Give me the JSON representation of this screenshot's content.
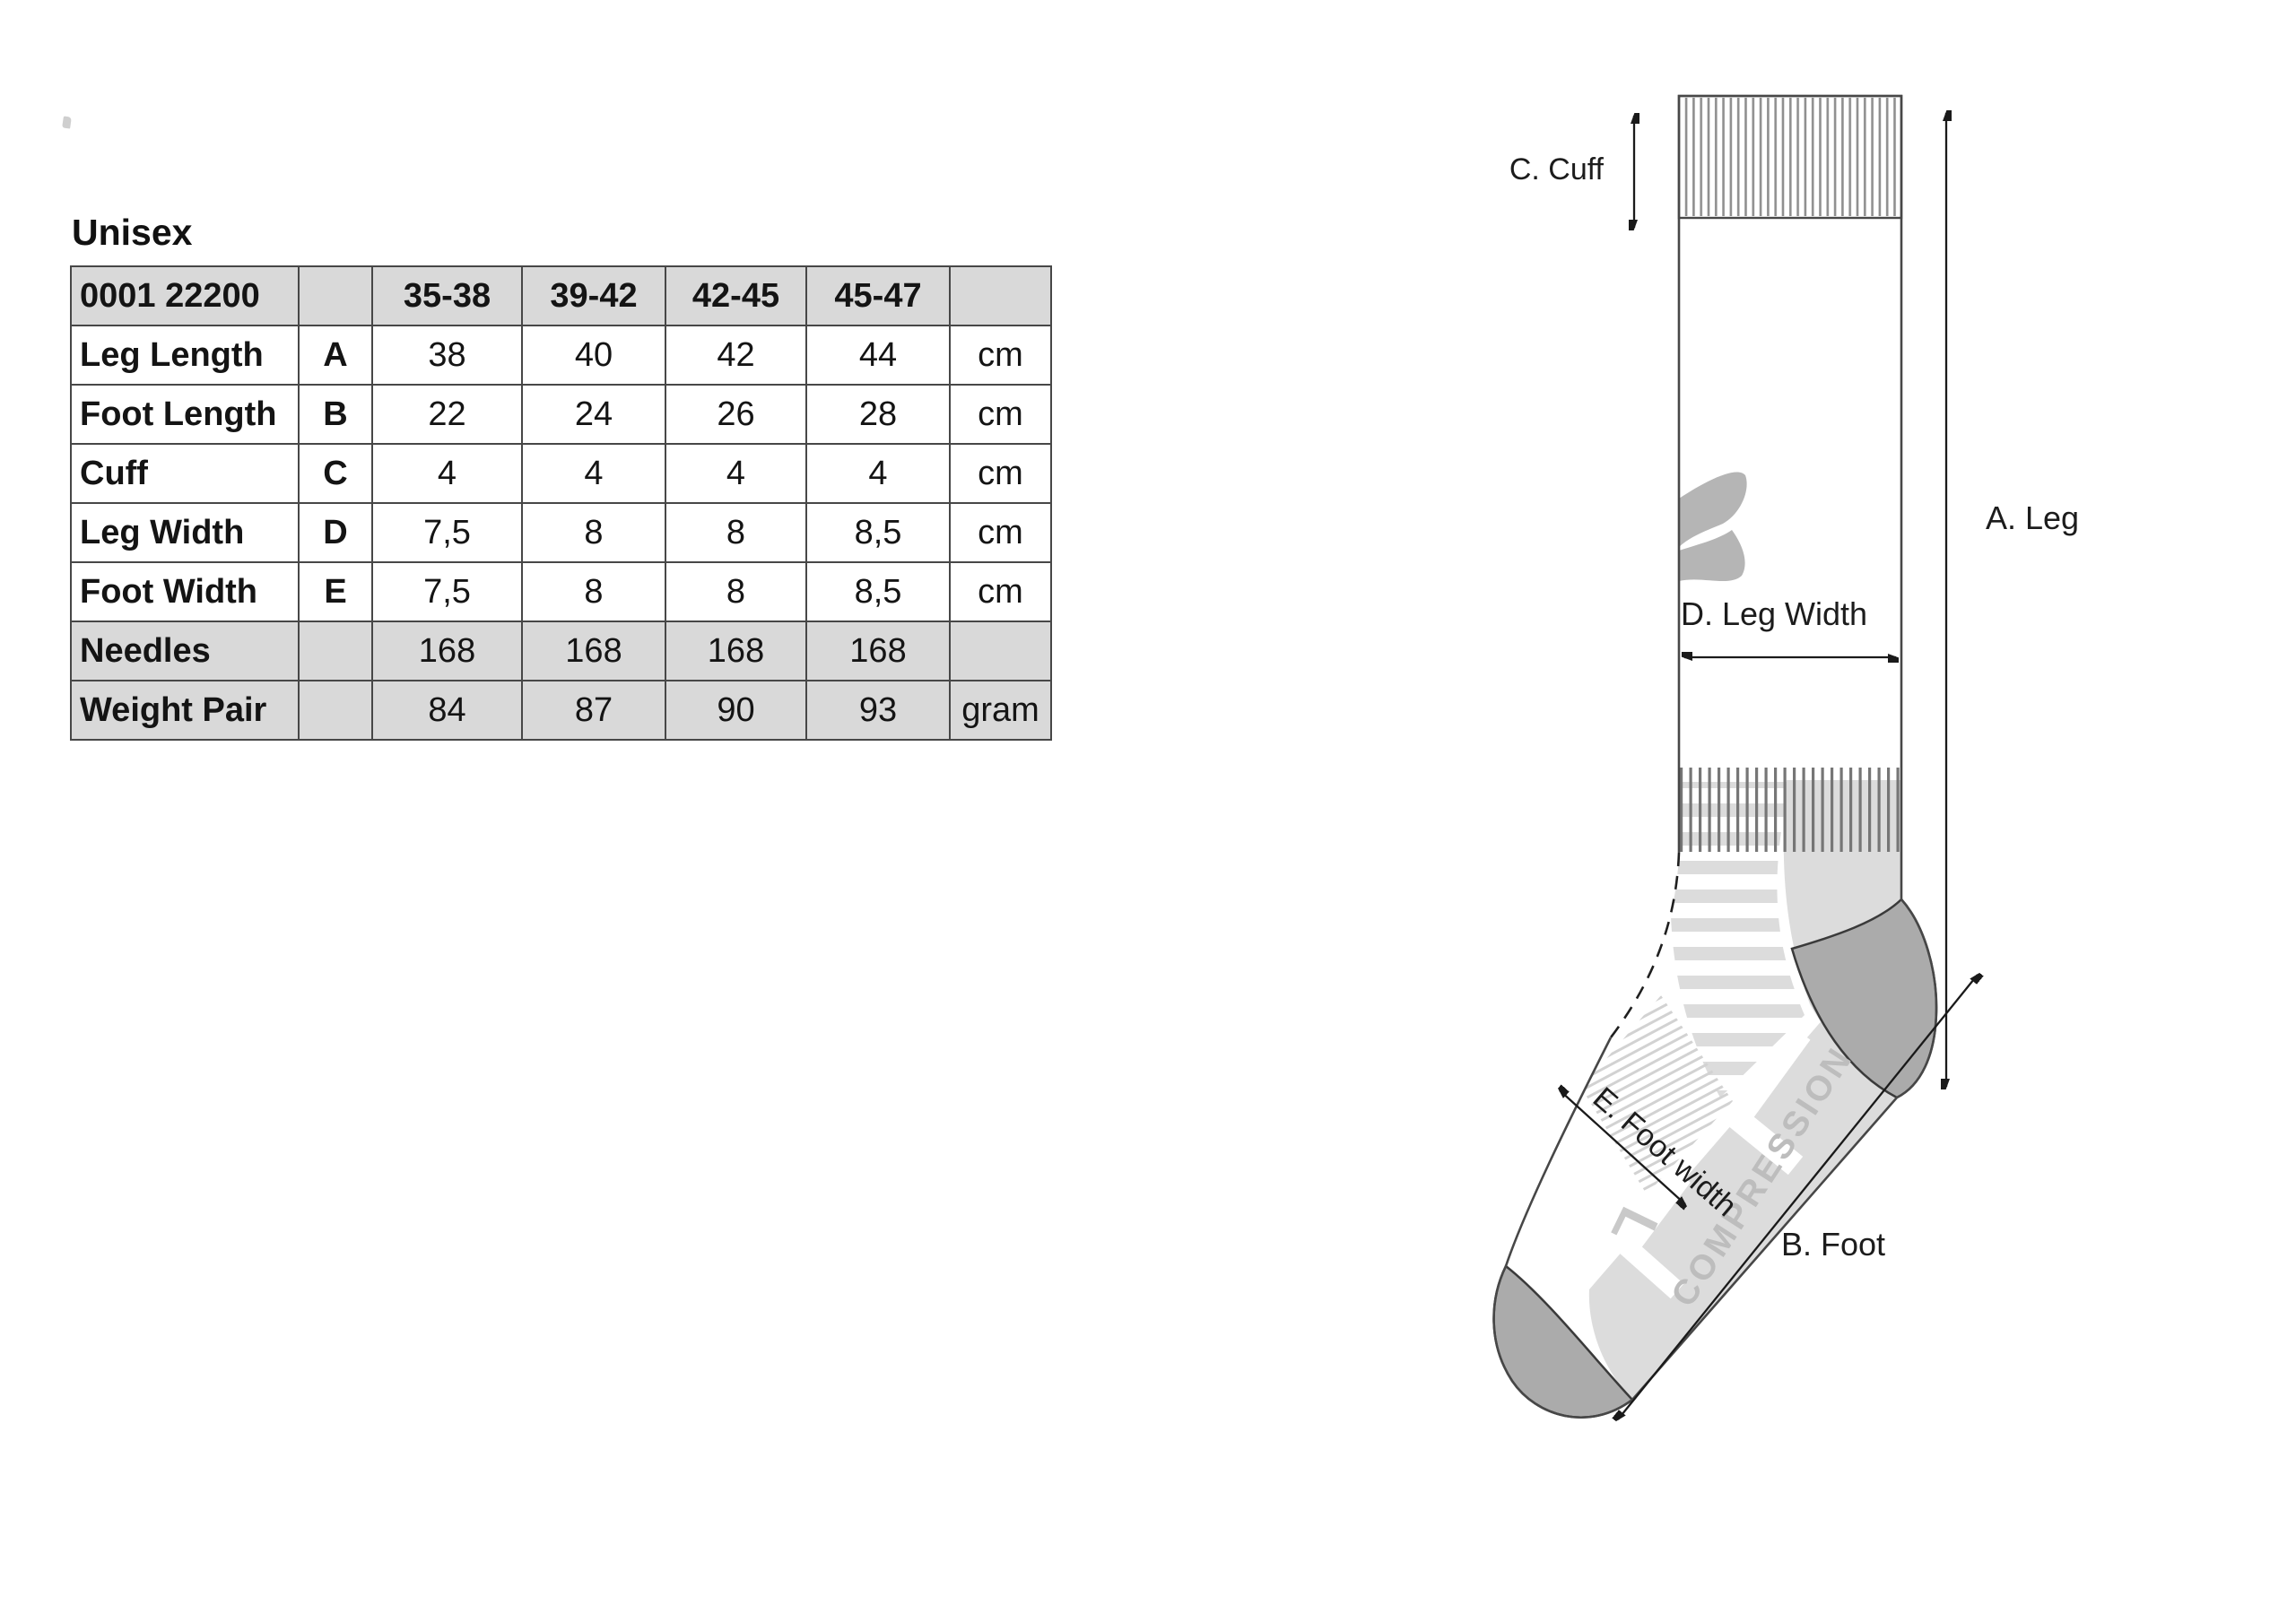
{
  "page": {
    "title": "Unisex"
  },
  "size_table": {
    "product_code": "0001 22200",
    "size_columns": [
      "35-38",
      "39-42",
      "42-45",
      "45-47"
    ],
    "rows": [
      {
        "label": "Leg Length",
        "letter": "A",
        "values": [
          "38",
          "40",
          "42",
          "44"
        ],
        "unit": "cm"
      },
      {
        "label": "Foot Length",
        "letter": "B",
        "values": [
          "22",
          "24",
          "26",
          "28"
        ],
        "unit": "cm"
      },
      {
        "label": "Cuff",
        "letter": "C",
        "values": [
          "4",
          "4",
          "4",
          "4"
        ],
        "unit": "cm"
      },
      {
        "label": "Leg Width",
        "letter": "D",
        "values": [
          "7,5",
          "8",
          "8",
          "8,5"
        ],
        "unit": "cm"
      },
      {
        "label": "Foot Width",
        "letter": "E",
        "values": [
          "7,5",
          "8",
          "8",
          "8,5"
        ],
        "unit": "cm"
      },
      {
        "label": "Needles",
        "letter": "",
        "values": [
          "168",
          "168",
          "168",
          "168"
        ],
        "unit": ""
      },
      {
        "label": "Weight Pair",
        "letter": "",
        "values": [
          "84",
          "87",
          "90",
          "93"
        ],
        "unit": "gram"
      }
    ]
  },
  "diagram": {
    "labels": {
      "leg": "A. Leg",
      "foot": "B. Foot",
      "cuff": "C. Cuff",
      "leg_width": "D. Leg Width",
      "foot_width": "E. Foot width"
    },
    "sock_text": "COMPRESSION",
    "size_mark": "L",
    "colors": {
      "pattern_gray": "#dcdcdc",
      "patch_gray": "#ababab",
      "rib_gray": "#8f8f8f",
      "outline": "#474747",
      "shaded_row": "#d9d9d9",
      "knit_text": "#bdbdbd"
    }
  }
}
